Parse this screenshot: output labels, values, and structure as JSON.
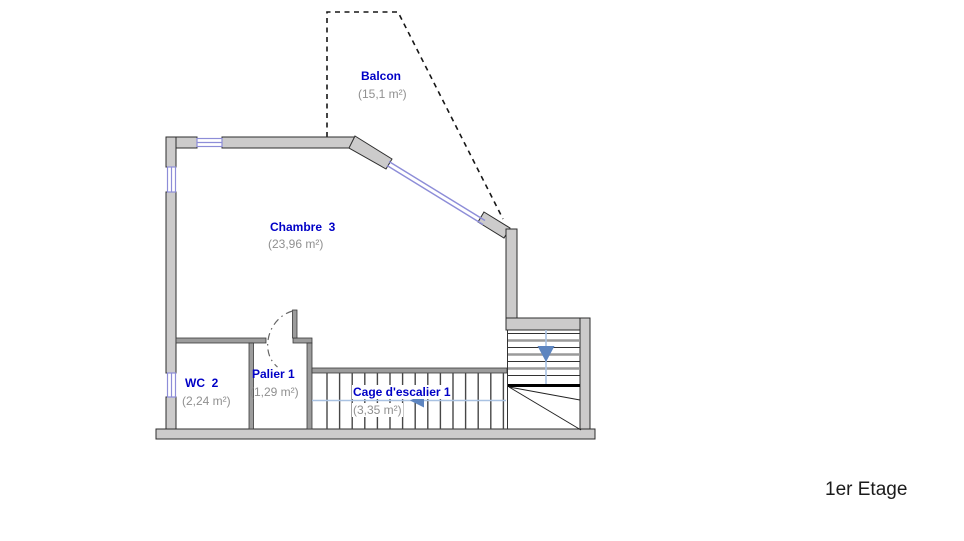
{
  "floor_label": "1er Etage",
  "rooms": [
    {
      "name": "Balcon",
      "area": "(15,1 m²)"
    },
    {
      "name": "Chambre  3",
      "area": "(23,96 m²)"
    },
    {
      "name": "WC  2",
      "area": "(2,24 m²)"
    },
    {
      "name": "Palier 1",
      "area": "(1,29 m²)"
    },
    {
      "name": "Cage d'escalier 1",
      "area": "(3,35 m²)"
    }
  ],
  "colors": {
    "room_label_blue": "#0000c6",
    "area_text_gray": "#909090",
    "wall_fill": "#cccbcb",
    "wall_stroke": "#2d2d2d",
    "window_blue": "#8d8dd8",
    "stair_path_blue": "#a9c2e2",
    "stair_arrow_blue": "#5d85c0",
    "balcony_dash": "#161616"
  },
  "icons": {
    "left_arrow": "stair direction arrow pointing left",
    "down_arrow": "stair direction arrow pointing down"
  }
}
